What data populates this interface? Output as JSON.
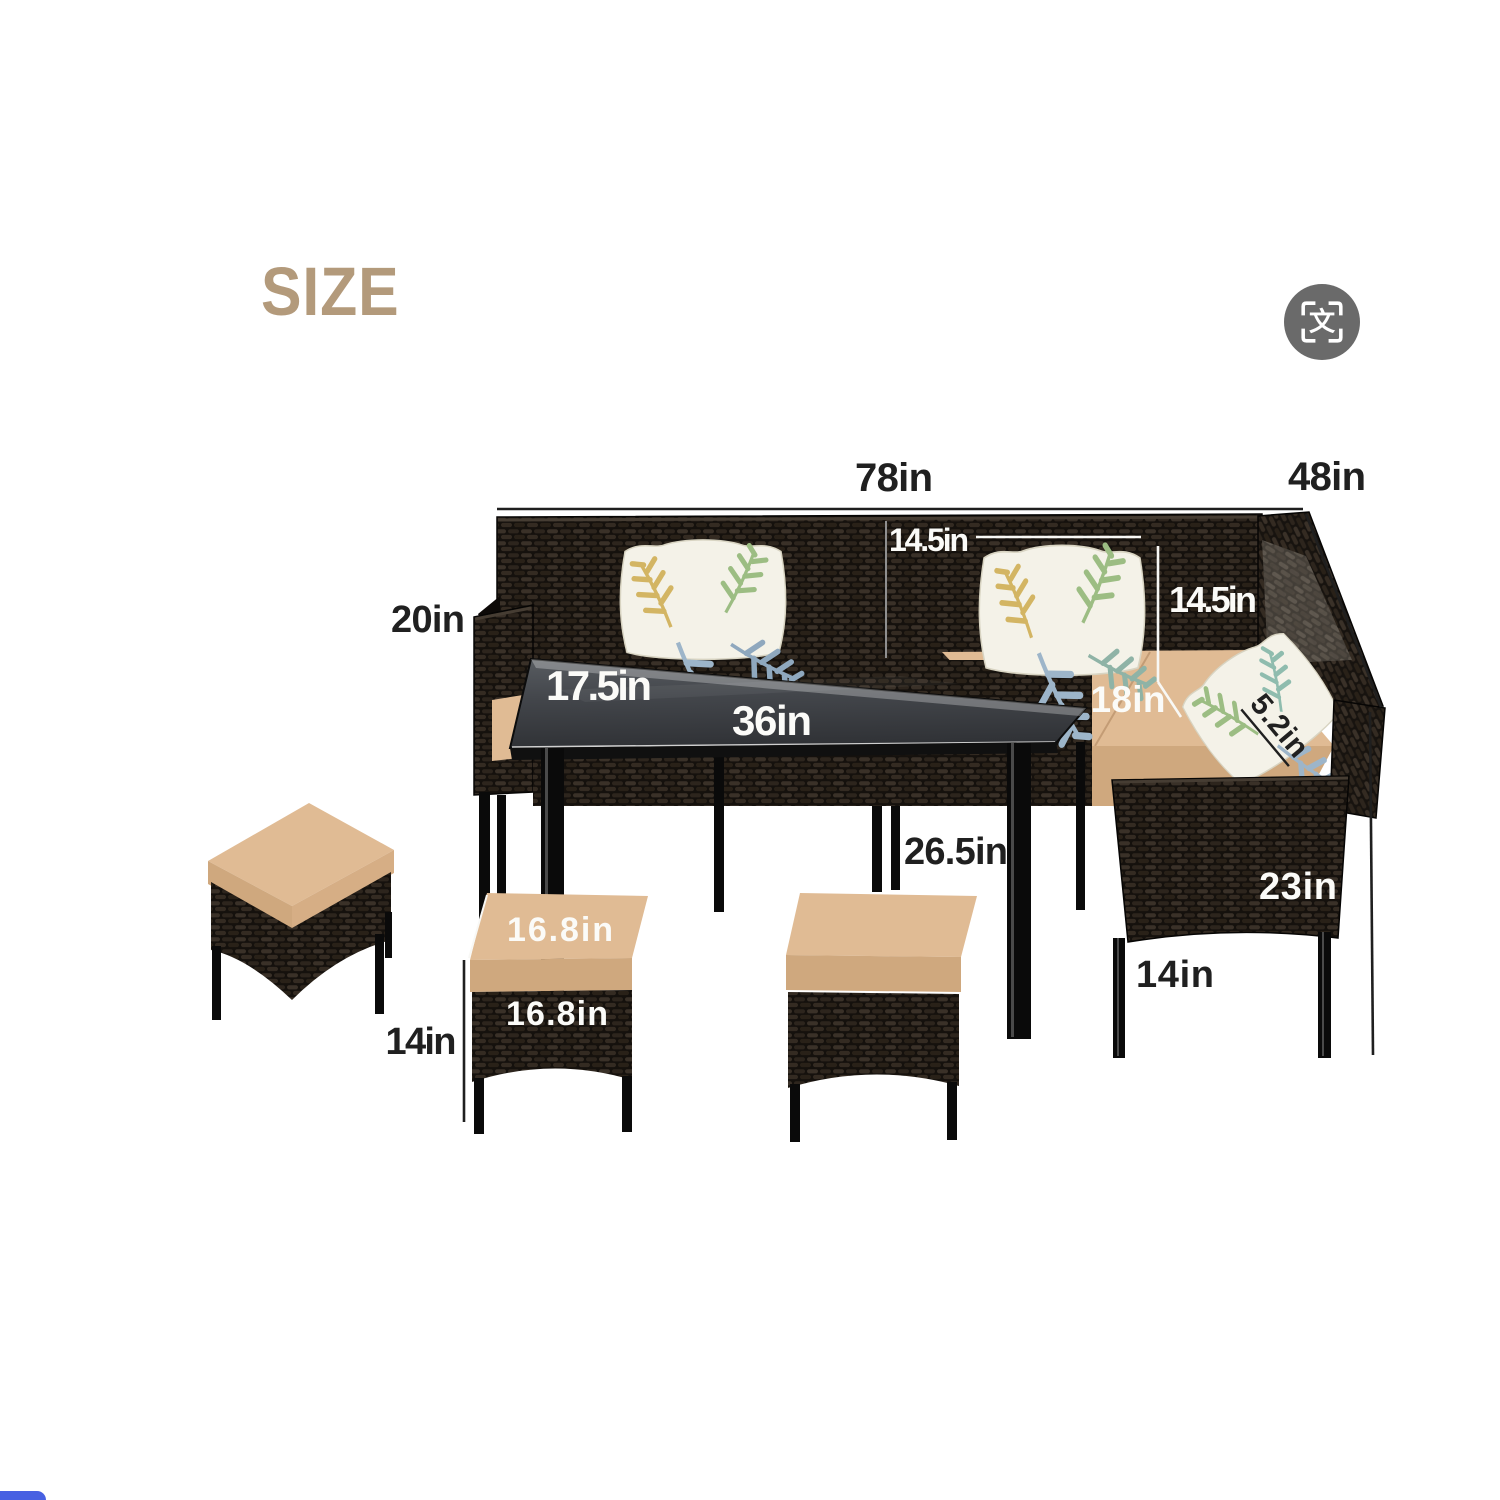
{
  "header": {
    "title": "SIZE",
    "translate_glyph": "文"
  },
  "dims": {
    "sofa_width": "78in",
    "sofa_depth": "48in",
    "arm_height": "20in",
    "pillow_width": "14.5in",
    "backrest_height": "14.5in",
    "table_depth": "17.5in",
    "table_length": "36in",
    "seat_depth": "18in",
    "cushion_thickness": "5.2in",
    "table_height": "26.5in",
    "chair_height": "23in",
    "chair_leg_height": "14in",
    "ottoman_height": "14in",
    "ottoman_top_width": "16.8in",
    "ottoman_front_width": "16.8in"
  },
  "colors": {
    "title": "#b39a7b",
    "label_dark": "#202020",
    "label_light": "#fbfbf8",
    "cushion_top": "#e0bb94",
    "cushion_side": "#cfa87e",
    "wicker_base": "#15110d",
    "table_glass": "#46494e",
    "pillow_base": "#f4f2e8",
    "leaf_green": "#9cbd83",
    "leaf_blue": "#9db5c9",
    "leaf_yellow": "#d3b563",
    "icon_bg": "#6a6a6a",
    "corner_accent": "#4760e2"
  }
}
